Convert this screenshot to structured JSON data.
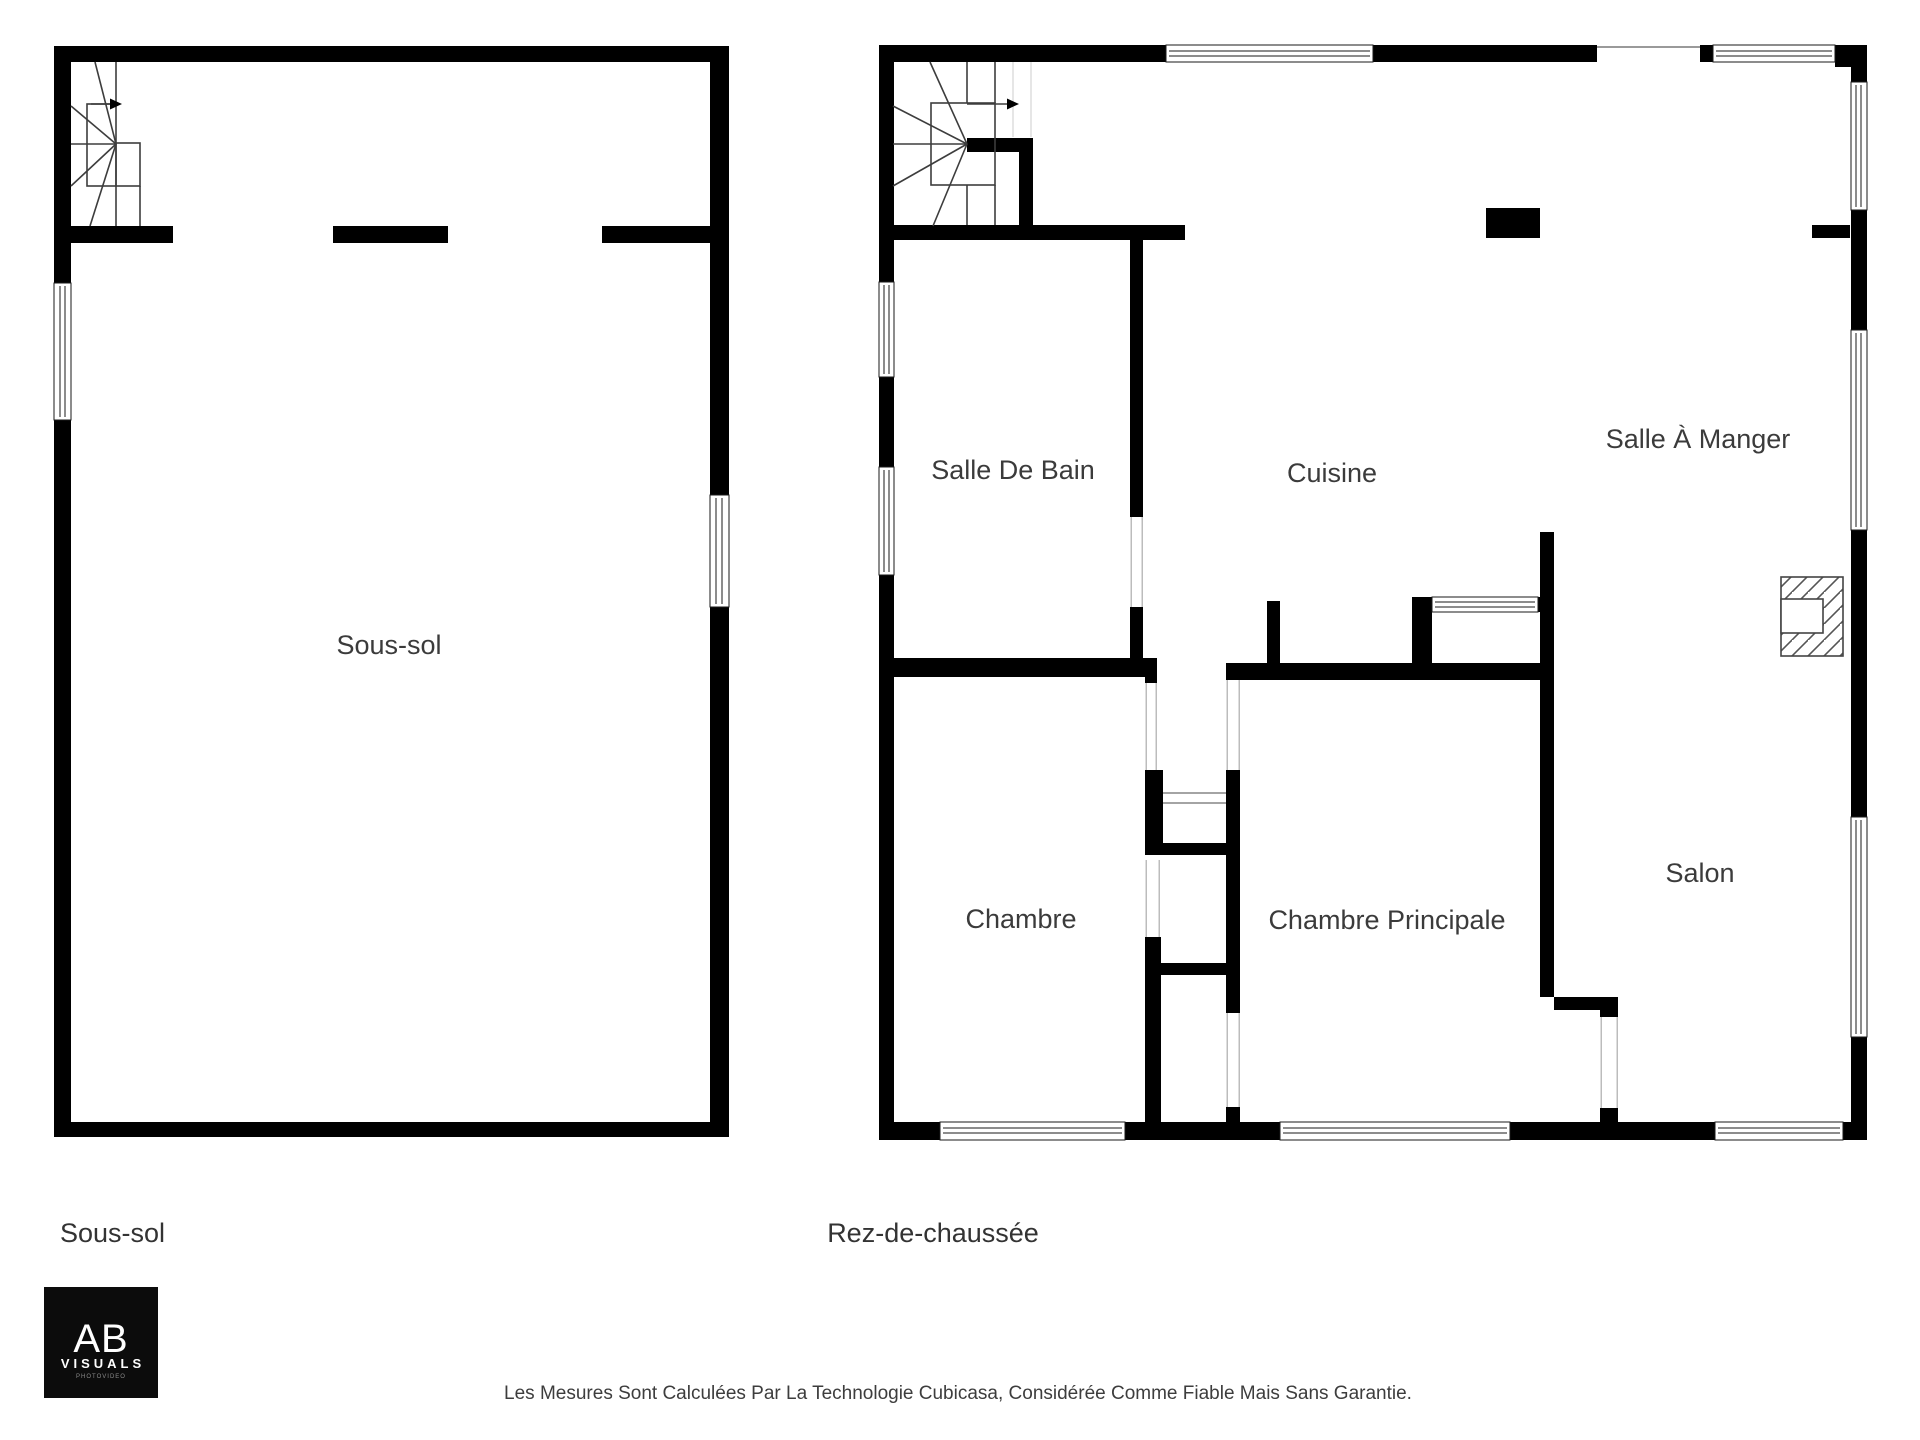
{
  "floors": [
    {
      "label": "Sous-sol",
      "rooms": [
        {
          "name": "Sous-sol"
        }
      ]
    },
    {
      "label": "Rez-de-chaussée",
      "rooms": [
        {
          "name": "Salle De Bain"
        },
        {
          "name": "Cuisine"
        },
        {
          "name": "Salle À Manger"
        },
        {
          "name": "Chambre"
        },
        {
          "name": "Chambre Principale"
        },
        {
          "name": "Salon"
        }
      ]
    }
  ],
  "logo": {
    "initials": "AB",
    "name": "VISUALS",
    "tagline": "PHOTOVIDEO"
  },
  "footer": {
    "disclaimer": "Les Mesures Sont Calculées Par La Technologie Cubicasa, Considérée Comme Fiable Mais Sans Garantie."
  },
  "colors": {
    "wall": "#000000",
    "label": "#3b3b3b",
    "background": "#ffffff",
    "logo_bg": "#0c0c0c"
  }
}
